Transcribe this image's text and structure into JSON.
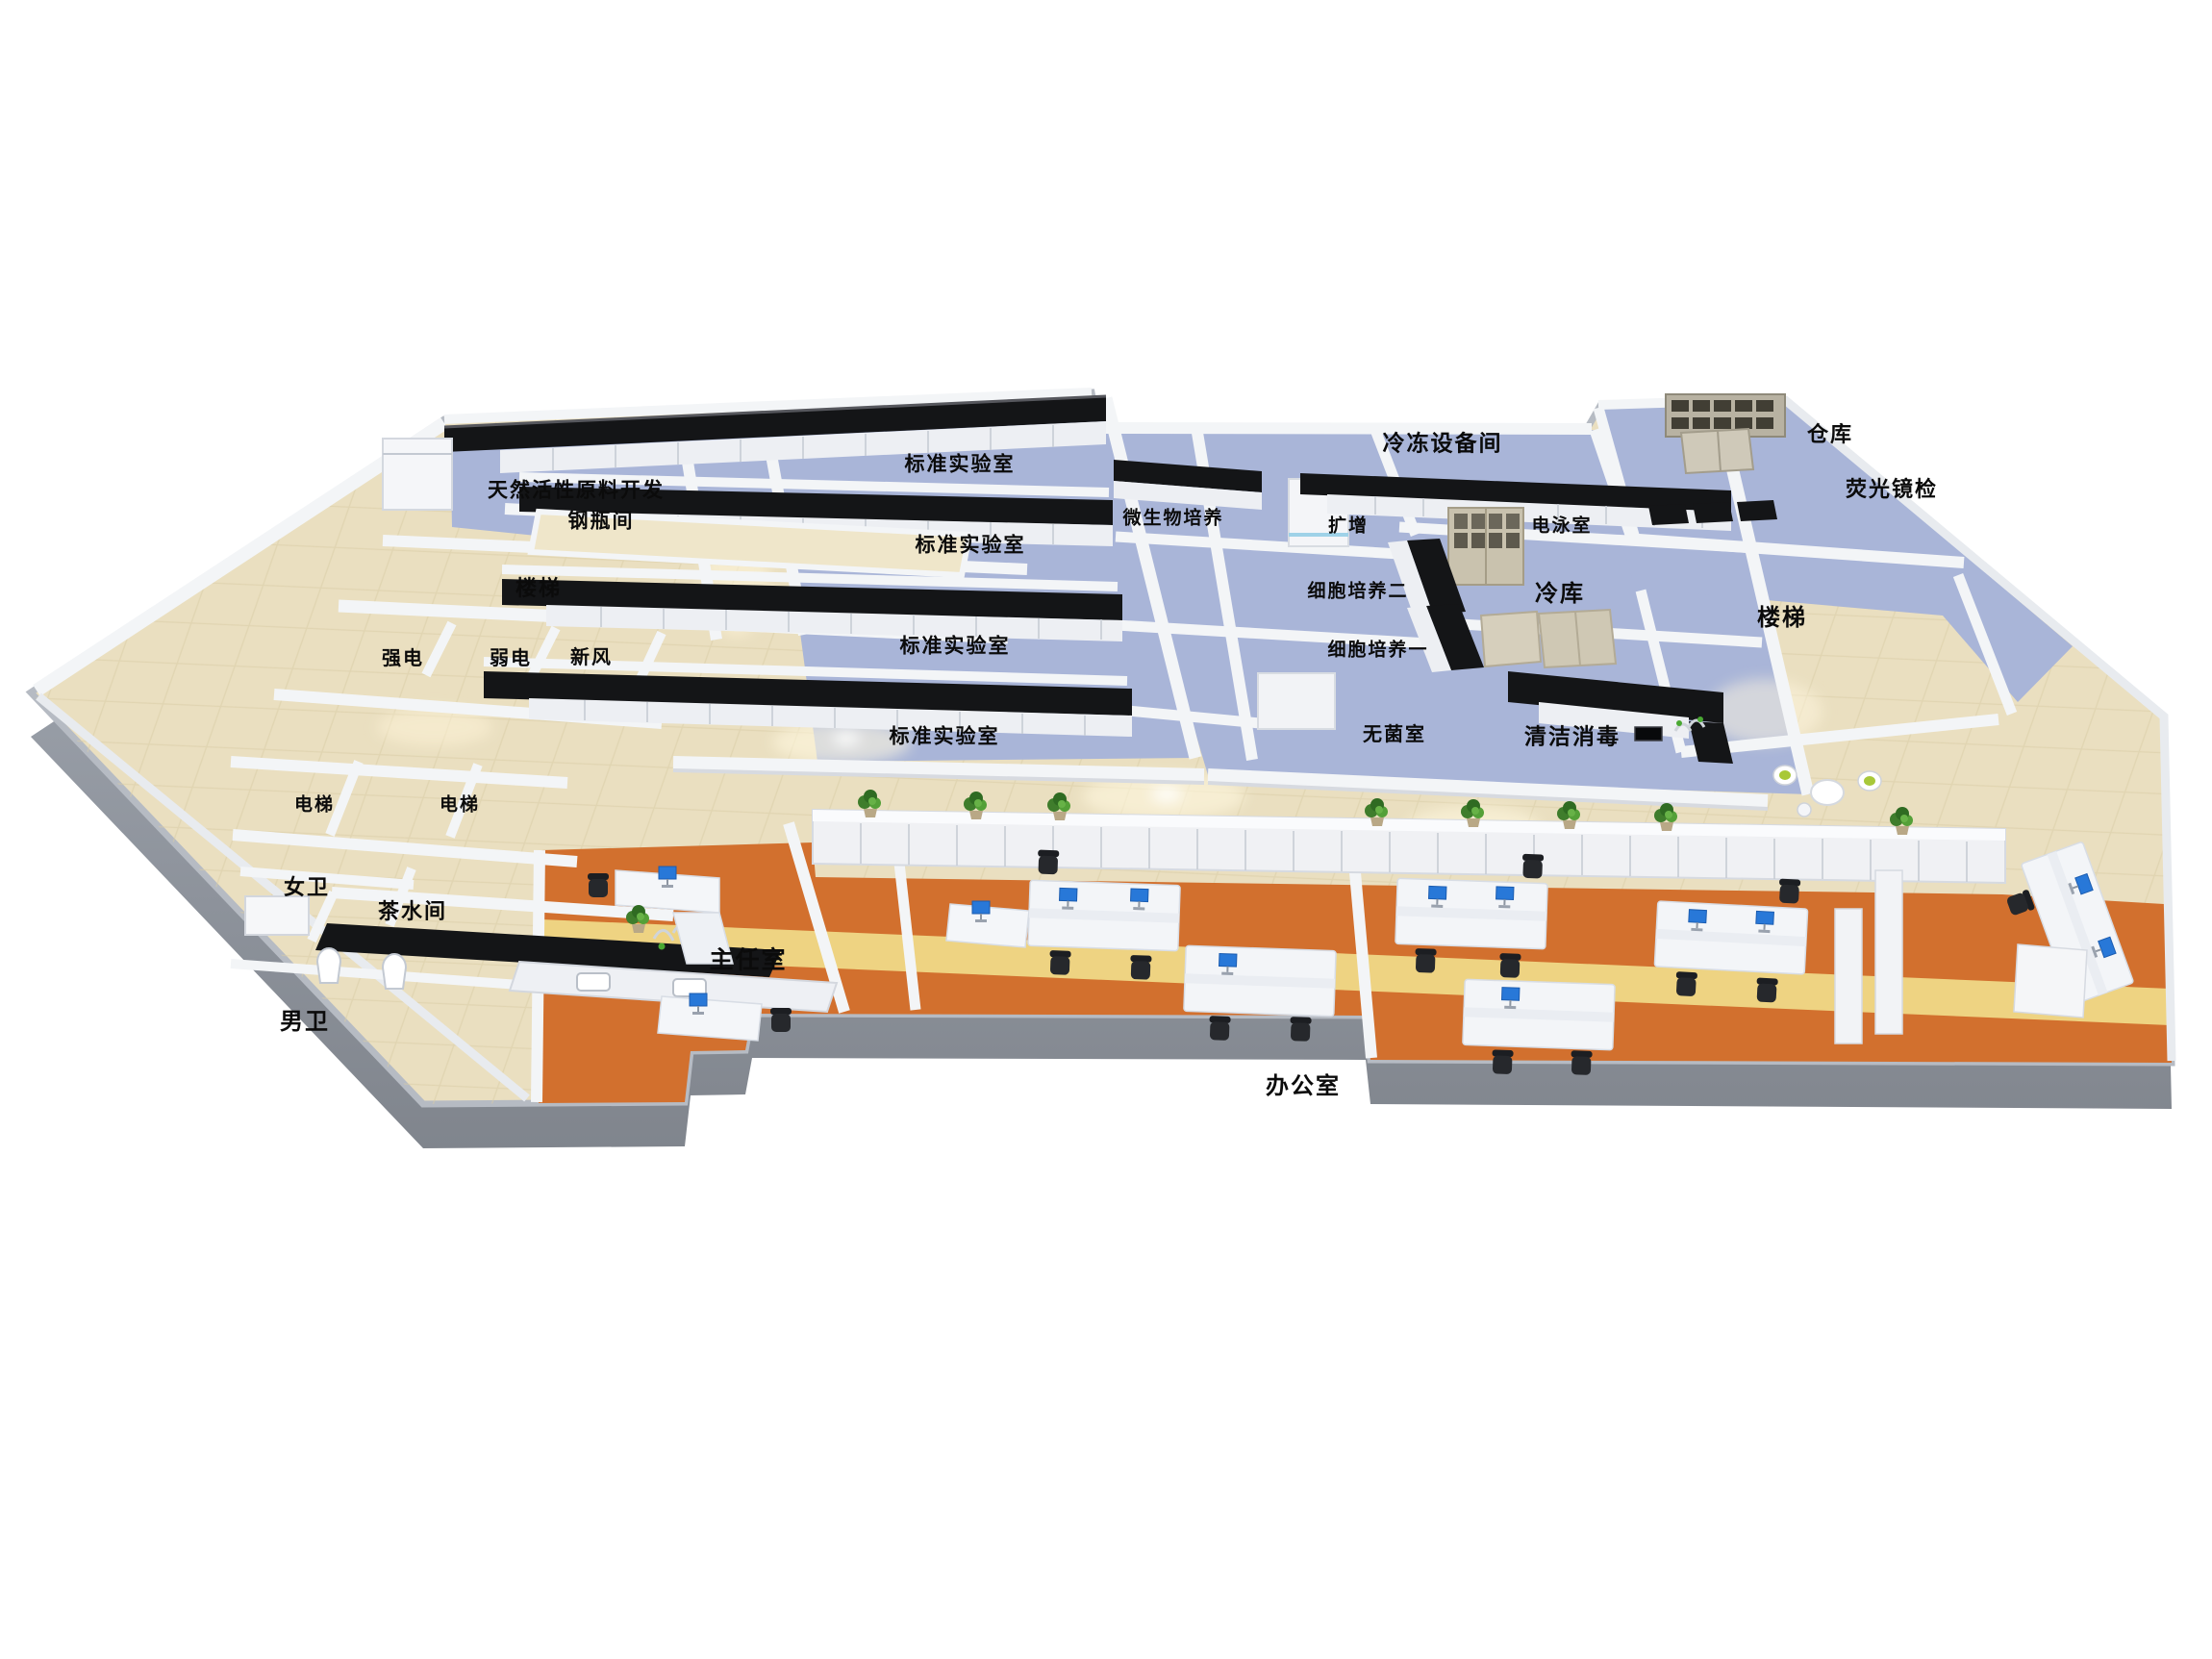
{
  "scene": {
    "kind": "3d-isometric-laboratory-floorplan-render",
    "background": "#ffffff"
  },
  "rooms": [
    {
      "id": "natural-actives-dev",
      "label": "天然活性原料开发"
    },
    {
      "id": "gas-cylinder-room",
      "label": "钢瓶间"
    },
    {
      "id": "stairs-left",
      "label": "楼梯"
    },
    {
      "id": "strong-power",
      "label": "强电"
    },
    {
      "id": "weak-power",
      "label": "弱电"
    },
    {
      "id": "fresh-air",
      "label": "新风"
    },
    {
      "id": "elevator-1",
      "label": "电梯"
    },
    {
      "id": "elevator-2",
      "label": "电梯"
    },
    {
      "id": "womens-restroom",
      "label": "女卫"
    },
    {
      "id": "tea-room",
      "label": "茶水间"
    },
    {
      "id": "mens-restroom",
      "label": "男卫"
    },
    {
      "id": "standard-lab-1",
      "label": "标准实验室"
    },
    {
      "id": "standard-lab-2",
      "label": "标准实验室"
    },
    {
      "id": "standard-lab-3",
      "label": "标准实验室"
    },
    {
      "id": "standard-lab-4",
      "label": "标准实验室"
    },
    {
      "id": "microbial-culture",
      "label": "微生物培养"
    },
    {
      "id": "freezer-equipment-room",
      "label": "冷冻设备间"
    },
    {
      "id": "amplification",
      "label": "扩增"
    },
    {
      "id": "electrophoresis-room",
      "label": "电泳室"
    },
    {
      "id": "cell-culture-2",
      "label": "细胞培养二"
    },
    {
      "id": "cold-storage",
      "label": "冷库"
    },
    {
      "id": "cell-culture-1",
      "label": "细胞培养一"
    },
    {
      "id": "sterile-room",
      "label": "无菌室"
    },
    {
      "id": "cleaning-disinfection",
      "label": "清洁消毒"
    },
    {
      "id": "warehouse",
      "label": "仓库"
    },
    {
      "id": "fluorescence-microscopy",
      "label": "荧光镜检"
    },
    {
      "id": "stairs-right",
      "label": "楼梯"
    },
    {
      "id": "director-office",
      "label": "主任室"
    },
    {
      "id": "open-office",
      "label": "办公室"
    }
  ],
  "colors": {
    "lab_floor_blue": "#a9b5d8",
    "corridor_floor_beige": "#eadfc0",
    "office_floor_orange": "#d2702e",
    "office_stripe_yellow": "#eed382",
    "wall_white": "#f3f5f7",
    "bench_black": "#141517",
    "plinth_gray": "#8f949d",
    "plant_green": "#4a8a33",
    "monitor_blue": "#2878d8",
    "label_text": "#0b0b0b"
  }
}
